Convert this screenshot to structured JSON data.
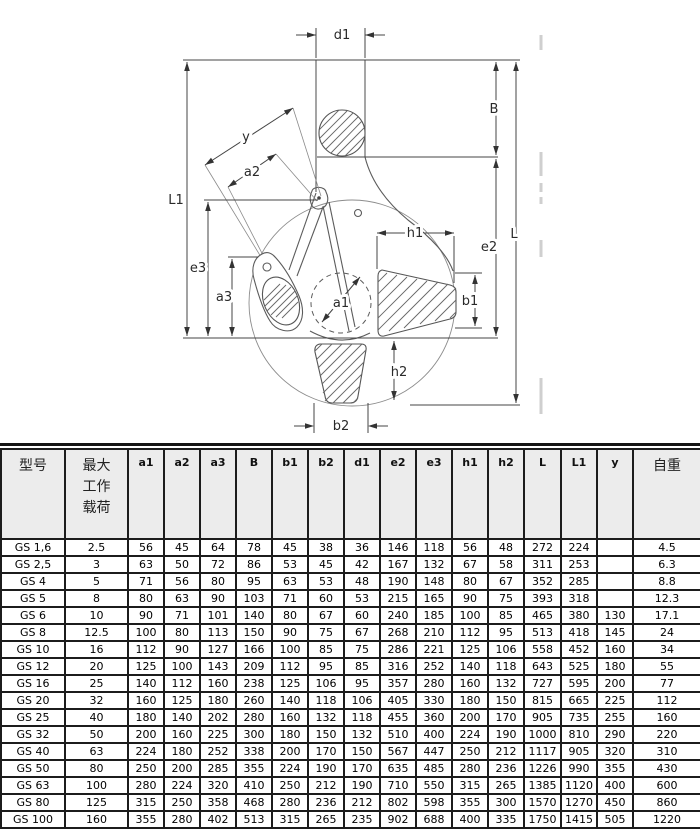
{
  "diagram": {
    "labels": {
      "d1": "d1",
      "B": "B",
      "y": "y",
      "a2": "a2",
      "L1": "L1",
      "e3": "e3",
      "a3": "a3",
      "a1": "a1",
      "h1": "h1",
      "e2": "e2",
      "L": "L",
      "b1": "b1",
      "h2": "h2",
      "b2": "b2"
    }
  },
  "table": {
    "columns": [
      {
        "key": "model",
        "label": "型号",
        "type": "cn"
      },
      {
        "key": "wll",
        "label": "最大\n工作\n载荷",
        "type": "cn"
      },
      {
        "key": "a1",
        "label": "a1",
        "type": "dim"
      },
      {
        "key": "a2",
        "label": "a2",
        "type": "dim"
      },
      {
        "key": "a3",
        "label": "a3",
        "type": "dim"
      },
      {
        "key": "B",
        "label": "B",
        "type": "dim"
      },
      {
        "key": "b1",
        "label": "b1",
        "type": "dim"
      },
      {
        "key": "b2",
        "label": "b2",
        "type": "dim"
      },
      {
        "key": "d1",
        "label": "d1",
        "type": "dim"
      },
      {
        "key": "e2",
        "label": "e2",
        "type": "dim"
      },
      {
        "key": "e3",
        "label": "e3",
        "type": "dim"
      },
      {
        "key": "h1",
        "label": "h1",
        "type": "dim"
      },
      {
        "key": "h2",
        "label": "h2",
        "type": "dim"
      },
      {
        "key": "L",
        "label": "L",
        "type": "dim"
      },
      {
        "key": "L1",
        "label": "L1",
        "type": "dim"
      },
      {
        "key": "y",
        "label": "y",
        "type": "dim"
      },
      {
        "key": "weight",
        "label": "自重",
        "type": "cn"
      }
    ],
    "rows": [
      [
        "GS 1,6",
        "2.5",
        "56",
        "45",
        "64",
        "78",
        "45",
        "38",
        "36",
        "146",
        "118",
        "56",
        "48",
        "272",
        "224",
        "",
        "4.5"
      ],
      [
        "GS 2,5",
        "3",
        "63",
        "50",
        "72",
        "86",
        "53",
        "45",
        "42",
        "167",
        "132",
        "67",
        "58",
        "311",
        "253",
        "",
        "6.3"
      ],
      [
        "GS 4",
        "5",
        "71",
        "56",
        "80",
        "95",
        "63",
        "53",
        "48",
        "190",
        "148",
        "80",
        "67",
        "352",
        "285",
        "",
        "8.8"
      ],
      [
        "GS 5",
        "8",
        "80",
        "63",
        "90",
        "103",
        "71",
        "60",
        "53",
        "215",
        "165",
        "90",
        "75",
        "393",
        "318",
        "",
        "12.3"
      ],
      [
        "GS 6",
        "10",
        "90",
        "71",
        "101",
        "140",
        "80",
        "67",
        "60",
        "240",
        "185",
        "100",
        "85",
        "465",
        "380",
        "130",
        "17.1"
      ],
      [
        "GS 8",
        "12.5",
        "100",
        "80",
        "113",
        "150",
        "90",
        "75",
        "67",
        "268",
        "210",
        "112",
        "95",
        "513",
        "418",
        "145",
        "24"
      ],
      [
        "GS 10",
        "16",
        "112",
        "90",
        "127",
        "166",
        "100",
        "85",
        "75",
        "286",
        "221",
        "125",
        "106",
        "558",
        "452",
        "160",
        "34"
      ],
      [
        "GS 12",
        "20",
        "125",
        "100",
        "143",
        "209",
        "112",
        "95",
        "85",
        "316",
        "252",
        "140",
        "118",
        "643",
        "525",
        "180",
        "55"
      ],
      [
        "GS 16",
        "25",
        "140",
        "112",
        "160",
        "238",
        "125",
        "106",
        "95",
        "357",
        "280",
        "160",
        "132",
        "727",
        "595",
        "200",
        "77"
      ],
      [
        "GS 20",
        "32",
        "160",
        "125",
        "180",
        "260",
        "140",
        "118",
        "106",
        "405",
        "330",
        "180",
        "150",
        "815",
        "665",
        "225",
        "112"
      ],
      [
        "GS 25",
        "40",
        "180",
        "140",
        "202",
        "280",
        "160",
        "132",
        "118",
        "455",
        "360",
        "200",
        "170",
        "905",
        "735",
        "255",
        "160"
      ],
      [
        "GS 32",
        "50",
        "200",
        "160",
        "225",
        "300",
        "180",
        "150",
        "132",
        "510",
        "400",
        "224",
        "190",
        "1000",
        "810",
        "290",
        "220"
      ],
      [
        "GS 40",
        "63",
        "224",
        "180",
        "252",
        "338",
        "200",
        "170",
        "150",
        "567",
        "447",
        "250",
        "212",
        "1117",
        "905",
        "320",
        "310"
      ],
      [
        "GS 50",
        "80",
        "250",
        "200",
        "285",
        "355",
        "224",
        "190",
        "170",
        "635",
        "485",
        "280",
        "236",
        "1226",
        "990",
        "355",
        "430"
      ],
      [
        "GS 63",
        "100",
        "280",
        "224",
        "320",
        "410",
        "250",
        "212",
        "190",
        "710",
        "550",
        "315",
        "265",
        "1385",
        "1120",
        "400",
        "600"
      ],
      [
        "GS 80",
        "125",
        "315",
        "250",
        "358",
        "468",
        "280",
        "236",
        "212",
        "802",
        "598",
        "355",
        "300",
        "1570",
        "1270",
        "450",
        "860"
      ],
      [
        "GS 100",
        "160",
        "355",
        "280",
        "402",
        "513",
        "315",
        "265",
        "235",
        "902",
        "688",
        "400",
        "335",
        "1750",
        "1415",
        "505",
        "1220"
      ]
    ]
  }
}
